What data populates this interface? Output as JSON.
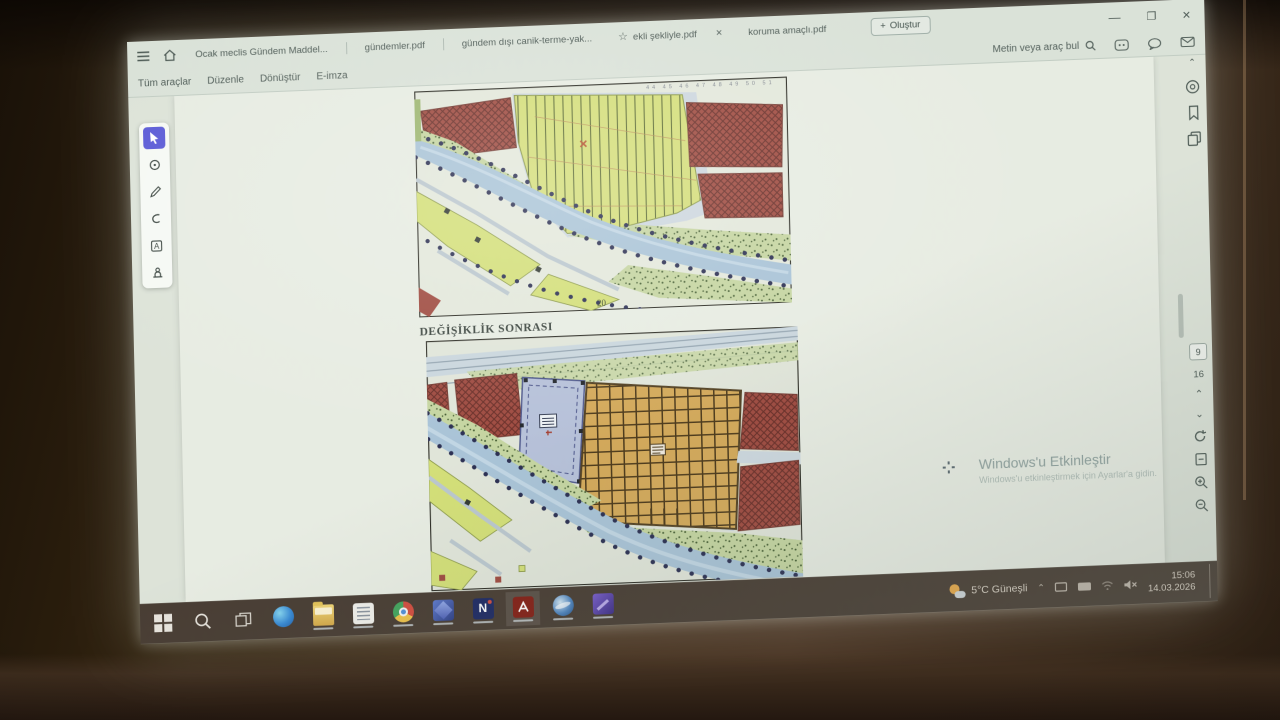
{
  "app": {
    "name": "Adobe Acrobat",
    "tabs": [
      {
        "label": "Ocak meclis Gündem Maddel..."
      },
      {
        "label": "gündemler.pdf"
      },
      {
        "label": "gündem dışı canik-terme-yak..."
      },
      {
        "label": "ekli şekliyle.pdf",
        "starred": true
      },
      {
        "label": "koruma amaçlı.pdf"
      }
    ],
    "create_button": "Oluştur",
    "menu_items": [
      "Tüm araçlar",
      "Düzenle",
      "Dönüştür",
      "E-imza"
    ],
    "search_placeholder": "Metin veya araç bul",
    "page_nav": {
      "current": "9",
      "total": "16"
    }
  },
  "document": {
    "section_label": "DEĞİŞİKLİK SONRASI",
    "top_map_scale_note": "20",
    "top_map_grid_numbers": "44 45 46 47 48 49 50 51",
    "map_legend_semantics": {
      "red_crosshatch": "built-up / housing blocks",
      "yellow_lined": "agricultural field",
      "orange_grid": "planned development block",
      "lavender_parcel": "facility parcel",
      "blue_band": "river",
      "green_stipple": "riparian vegetation",
      "navy_dots": "boundary point markers"
    }
  },
  "desktop": {
    "watermark_line1": "Windows'u Etkinleştir",
    "watermark_line2": "Windows'u etkinleştirmek için Ayarlar'a gidin.",
    "taskbar": {
      "weather": "5°C Güneşli",
      "time": "15:06",
      "date": "14.03.2026"
    }
  },
  "palette": {
    "accent_tool_selected": "#5b5be6",
    "screen_tint": "#dfe7dd",
    "taskbar": "#4a3d32",
    "map_red": "#a8493d",
    "map_red_hatch": "#6e2d26",
    "map_yellow": "#d4df6e",
    "map_orange": "#d9a94f",
    "map_river": "#a6c4da",
    "map_lavender": "#b5c1dc",
    "map_stipple": "#c4d69b",
    "map_dot": "#2c3158",
    "acrobat_red": "#b02a20"
  }
}
